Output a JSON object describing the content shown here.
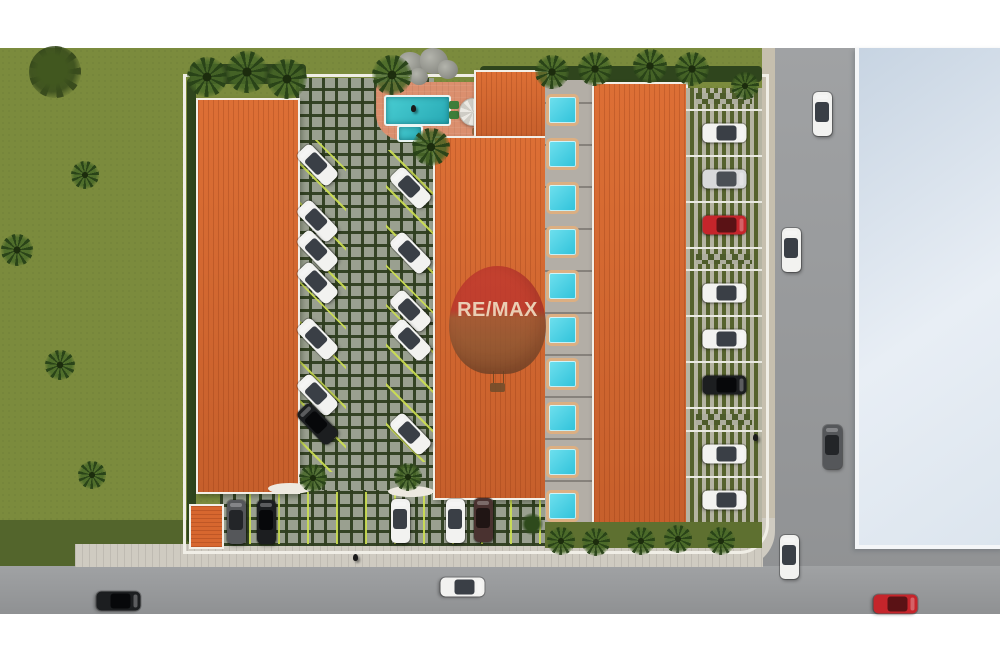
{
  "watermark": {
    "text": "RE/MAX",
    "balloon_top_color": "#C13A2F",
    "balloon_bottom_color": "#7E4E2E",
    "text_color": "#EFE2CC"
  },
  "palette": {
    "grass": "#7B8B3D",
    "hedge": "#2F451D",
    "roof_orange": "#D7672F",
    "paver_grey": "#9AA090",
    "paver_joint_green": "#3A4A28",
    "road_grey": "#9A9C9E",
    "sidewalk": "#CFCBC1",
    "pool_teal": "#2FB6BD",
    "plunge_cyan": "#45D0E4",
    "pool_trim_tan": "#DCAF82",
    "neighbor_roof_blue": "#D5DFEA",
    "stall_line_yellow": "#CDE050",
    "wall_white": "#F0EEE6"
  },
  "scene": {
    "objects": [
      {
        "name": "grass-field",
        "cls": "grass",
        "x": 0,
        "y": 48,
        "w": 775,
        "h": 520
      },
      {
        "name": "grass-dark-strip",
        "cls": "grass-dark",
        "x": 0,
        "y": 520,
        "w": 218,
        "h": 48
      },
      {
        "name": "road-right",
        "cls": "road",
        "x": 762,
        "y": 48,
        "w": 238,
        "h": 566
      },
      {
        "name": "road-bottom",
        "cls": "road",
        "x": 0,
        "y": 566,
        "w": 1000,
        "h": 48
      },
      {
        "name": "sidewalk-right",
        "cls": "sidewalk-v",
        "x": 762,
        "y": 48,
        "w": 13,
        "h": 478
      },
      {
        "name": "sidewalk-corner",
        "cls": "sidewalk-corner",
        "x": 733,
        "y": 518,
        "w": 42,
        "h": 49
      },
      {
        "name": "sidewalk-bottom",
        "cls": "sidewalk-h",
        "x": 75,
        "y": 544,
        "w": 688,
        "h": 23
      },
      {
        "name": "neighbor-building-roof",
        "cls": "bldg-blue",
        "x": 855,
        "y": 48,
        "w": 145,
        "h": 497
      },
      {
        "name": "site-boundary-wall",
        "cls": "site-wall",
        "x": 183,
        "y": 74,
        "w": 580,
        "h": 474
      },
      {
        "name": "hedge-left",
        "cls": "hedge",
        "x": 187,
        "y": 78,
        "w": 9,
        "h": 465
      },
      {
        "name": "hedge-top-left",
        "cls": "hedge",
        "x": 190,
        "y": 64,
        "w": 116,
        "h": 20
      },
      {
        "name": "hedge-top-right",
        "cls": "hedge",
        "x": 480,
        "y": 66,
        "w": 282,
        "h": 16
      },
      {
        "name": "courtyard-pavers",
        "cls": "pavers",
        "x": 296,
        "y": 78,
        "w": 138,
        "h": 468
      },
      {
        "name": "bottom-parking-pavers",
        "cls": "pavers",
        "x": 220,
        "y": 490,
        "w": 325,
        "h": 56
      },
      {
        "name": "stall-lines-left-column",
        "cls": "stalls-diag",
        "x": 293,
        "y": 140,
        "w": 53,
        "h": 332
      },
      {
        "name": "stall-lines-right-column",
        "cls": "stalls-diag",
        "x": 386,
        "y": 150,
        "w": 50,
        "h": 312
      },
      {
        "name": "stall-lines-bottom-row",
        "cls": "stalls-vert",
        "x": 222,
        "y": 492,
        "w": 320,
        "h": 52
      },
      {
        "name": "pool-deck",
        "cls": "deck",
        "x": 376,
        "y": 82,
        "w": 144,
        "h": 58
      },
      {
        "name": "swimming-pool",
        "cls": "pool",
        "x": 384,
        "y": 95,
        "w": 63,
        "h": 27
      },
      {
        "name": "kiddie-pool",
        "cls": "pool",
        "x": 397,
        "y": 125,
        "w": 22,
        "h": 13
      },
      {
        "name": "lounger",
        "cls": "lounger",
        "x": 449,
        "y": 101,
        "w": 10,
        "h": 8
      },
      {
        "name": "lounger",
        "cls": "lounger",
        "x": 449,
        "y": 111,
        "w": 10,
        "h": 8
      },
      {
        "name": "deck-chair",
        "cls": "chair",
        "x": 472,
        "y": 128,
        "w": 8,
        "h": 7
      },
      {
        "name": "deck-chair",
        "cls": "chair",
        "x": 482,
        "y": 128,
        "w": 8,
        "h": 7
      },
      {
        "name": "palapa-umbrella",
        "cls": "palapa",
        "x": 459,
        "y": 98,
        "w": 26,
        "h": 26
      },
      {
        "name": "building-left-roof",
        "cls": "bldg-orange",
        "x": 196,
        "y": 98,
        "w": 100,
        "h": 392
      },
      {
        "name": "building-middle-wing-roof",
        "cls": "bldg-orange",
        "x": 474,
        "y": 70,
        "w": 71,
        "h": 68
      },
      {
        "name": "building-middle-roof",
        "cls": "bldg-orange",
        "x": 433,
        "y": 136,
        "w": 112,
        "h": 360
      },
      {
        "name": "unit-walkway",
        "cls": "walkway",
        "x": 545,
        "y": 80,
        "w": 47,
        "h": 442
      },
      {
        "name": "plunge-pool",
        "cls": "plunge",
        "x": 546,
        "y": 94,
        "w": 27,
        "h": 26
      },
      {
        "name": "plunge-pool",
        "cls": "plunge",
        "x": 546,
        "y": 138,
        "w": 27,
        "h": 26
      },
      {
        "name": "plunge-pool",
        "cls": "plunge",
        "x": 546,
        "y": 182,
        "w": 27,
        "h": 26
      },
      {
        "name": "plunge-pool",
        "cls": "plunge",
        "x": 546,
        "y": 226,
        "w": 27,
        "h": 26
      },
      {
        "name": "plunge-pool",
        "cls": "plunge",
        "x": 546,
        "y": 270,
        "w": 27,
        "h": 26
      },
      {
        "name": "plunge-pool",
        "cls": "plunge",
        "x": 546,
        "y": 314,
        "w": 27,
        "h": 26
      },
      {
        "name": "plunge-pool",
        "cls": "plunge",
        "x": 546,
        "y": 358,
        "w": 27,
        "h": 26
      },
      {
        "name": "plunge-pool",
        "cls": "plunge",
        "x": 546,
        "y": 402,
        "w": 27,
        "h": 26
      },
      {
        "name": "plunge-pool",
        "cls": "plunge",
        "x": 546,
        "y": 446,
        "w": 27,
        "h": 26
      },
      {
        "name": "plunge-pool",
        "cls": "plunge",
        "x": 546,
        "y": 490,
        "w": 27,
        "h": 26
      },
      {
        "name": "building-right-roof",
        "cls": "bldg-orange",
        "x": 592,
        "y": 82,
        "w": 92,
        "h": 448
      },
      {
        "name": "green-strip-bottom",
        "cls": "grass-dark2",
        "x": 545,
        "y": 522,
        "w": 217,
        "h": 26
      },
      {
        "name": "entrance-kiosk-roof",
        "cls": "kiosk",
        "x": 189,
        "y": 504,
        "w": 31,
        "h": 41
      },
      {
        "name": "curb-island",
        "cls": "curb",
        "x": 268,
        "y": 483,
        "w": 44,
        "h": 11
      },
      {
        "name": "curb-island",
        "cls": "curb",
        "x": 388,
        "y": 486,
        "w": 46,
        "h": 11
      },
      {
        "name": "rock-feature",
        "cls": "rock",
        "x": 398,
        "y": 52,
        "w": 26,
        "h": 24
      },
      {
        "name": "rock-feature",
        "cls": "rock",
        "x": 420,
        "y": 48,
        "w": 28,
        "h": 26
      },
      {
        "name": "rock-feature",
        "cls": "rock",
        "x": 438,
        "y": 60,
        "w": 20,
        "h": 19
      },
      {
        "name": "rock-feature",
        "cls": "rock",
        "x": 410,
        "y": 68,
        "w": 18,
        "h": 17
      }
    ],
    "right_parking": {
      "x": 686,
      "y": 88,
      "w": 76,
      "h": 434,
      "bays": [
        {
          "pattern": "grid"
        },
        {
          "car": "white"
        },
        {
          "car": "silver"
        },
        {
          "car": "red"
        },
        {
          "pattern": "grid"
        },
        {
          "car": "white"
        },
        {
          "car": "white"
        },
        {
          "car": "black"
        },
        {
          "pattern": "grid"
        },
        {
          "car": "white"
        },
        {
          "car": "white"
        }
      ]
    },
    "car_colors": {
      "white": {
        "body": "#F2F2F0",
        "window": "#3A3F46"
      },
      "silver": {
        "body": "#D8D9DB",
        "window": "#4A4F55"
      },
      "black": {
        "body": "#1C1E20",
        "window": "#07080A"
      },
      "red": {
        "body": "#C5252B",
        "window": "#5A1215"
      },
      "graydark": {
        "body": "#55575A",
        "window": "#232528"
      },
      "brown": {
        "body": "#4A3230",
        "window": "#201514"
      }
    },
    "cars": [
      {
        "x": 317,
        "y": 165,
        "rot": -44,
        "color": "white"
      },
      {
        "x": 317,
        "y": 221,
        "rot": -44,
        "color": "white"
      },
      {
        "x": 317,
        "y": 251,
        "rot": -44,
        "color": "white"
      },
      {
        "x": 317,
        "y": 283,
        "rot": -44,
        "color": "white"
      },
      {
        "x": 317,
        "y": 339,
        "rot": -44,
        "color": "white"
      },
      {
        "x": 317,
        "y": 395,
        "rot": -44,
        "color": "white"
      },
      {
        "x": 317,
        "y": 424,
        "rot": -44,
        "color": "black"
      },
      {
        "x": 410,
        "y": 188,
        "rot": -44,
        "color": "white"
      },
      {
        "x": 410,
        "y": 253,
        "rot": -44,
        "color": "white"
      },
      {
        "x": 410,
        "y": 311,
        "rot": -44,
        "color": "white"
      },
      {
        "x": 410,
        "y": 340,
        "rot": -44,
        "color": "white"
      },
      {
        "x": 410,
        "y": 434,
        "rot": -44,
        "color": "white"
      },
      {
        "x": 236,
        "y": 522,
        "rot": 0,
        "color": "graydark"
      },
      {
        "x": 266,
        "y": 522,
        "rot": 0,
        "color": "black"
      },
      {
        "x": 400,
        "y": 521,
        "rot": 0,
        "color": "white"
      },
      {
        "x": 455,
        "y": 521,
        "rot": 0,
        "color": "white"
      },
      {
        "x": 483,
        "y": 520,
        "rot": 0,
        "color": "brown"
      },
      {
        "x": 118,
        "y": 601,
        "rot": 90,
        "color": "black"
      },
      {
        "x": 462,
        "y": 587,
        "rot": 90,
        "color": "white"
      },
      {
        "x": 895,
        "y": 604,
        "rot": 90,
        "color": "red"
      },
      {
        "x": 822,
        "y": 114,
        "rot": 0,
        "color": "white"
      },
      {
        "x": 791,
        "y": 250,
        "rot": 0,
        "color": "white"
      },
      {
        "x": 832,
        "y": 447,
        "rot": 0,
        "color": "graydark"
      },
      {
        "x": 789,
        "y": 557,
        "rot": 0,
        "color": "white"
      }
    ],
    "palms": [
      {
        "x": 55,
        "y": 72,
        "r": 26,
        "type": "tree"
      },
      {
        "x": 85,
        "y": 175,
        "r": 14,
        "type": "palm"
      },
      {
        "x": 17,
        "y": 250,
        "r": 16,
        "type": "palm"
      },
      {
        "x": 60,
        "y": 365,
        "r": 15,
        "type": "palm"
      },
      {
        "x": 92,
        "y": 475,
        "r": 14,
        "type": "palm"
      },
      {
        "x": 207,
        "y": 77,
        "r": 20,
        "type": "palm"
      },
      {
        "x": 247,
        "y": 72,
        "r": 21,
        "type": "palm"
      },
      {
        "x": 287,
        "y": 79,
        "r": 20,
        "type": "palm"
      },
      {
        "x": 392,
        "y": 75,
        "r": 20,
        "type": "palm"
      },
      {
        "x": 431,
        "y": 147,
        "r": 19,
        "type": "palm"
      },
      {
        "x": 313,
        "y": 478,
        "r": 14,
        "type": "palm"
      },
      {
        "x": 408,
        "y": 477,
        "r": 14,
        "type": "palm"
      },
      {
        "x": 552,
        "y": 72,
        "r": 17,
        "type": "palm"
      },
      {
        "x": 595,
        "y": 69,
        "r": 17,
        "type": "palm"
      },
      {
        "x": 650,
        "y": 66,
        "r": 17,
        "type": "palm"
      },
      {
        "x": 692,
        "y": 69,
        "r": 17,
        "type": "palm"
      },
      {
        "x": 745,
        "y": 86,
        "r": 14,
        "type": "palm"
      },
      {
        "x": 561,
        "y": 541,
        "r": 14,
        "type": "palm"
      },
      {
        "x": 596,
        "y": 542,
        "r": 14,
        "type": "palm"
      },
      {
        "x": 641,
        "y": 541,
        "r": 14,
        "type": "palm"
      },
      {
        "x": 678,
        "y": 539,
        "r": 14,
        "type": "palm"
      },
      {
        "x": 721,
        "y": 541,
        "r": 14,
        "type": "palm"
      },
      {
        "x": 532,
        "y": 524,
        "r": 11,
        "type": "bush"
      }
    ],
    "pedestrians": [
      {
        "x": 355,
        "y": 557,
        "name": "pedestrian"
      },
      {
        "x": 755,
        "y": 437,
        "name": "pedestrian"
      },
      {
        "x": 413,
        "y": 108,
        "name": "swimmer"
      }
    ]
  }
}
